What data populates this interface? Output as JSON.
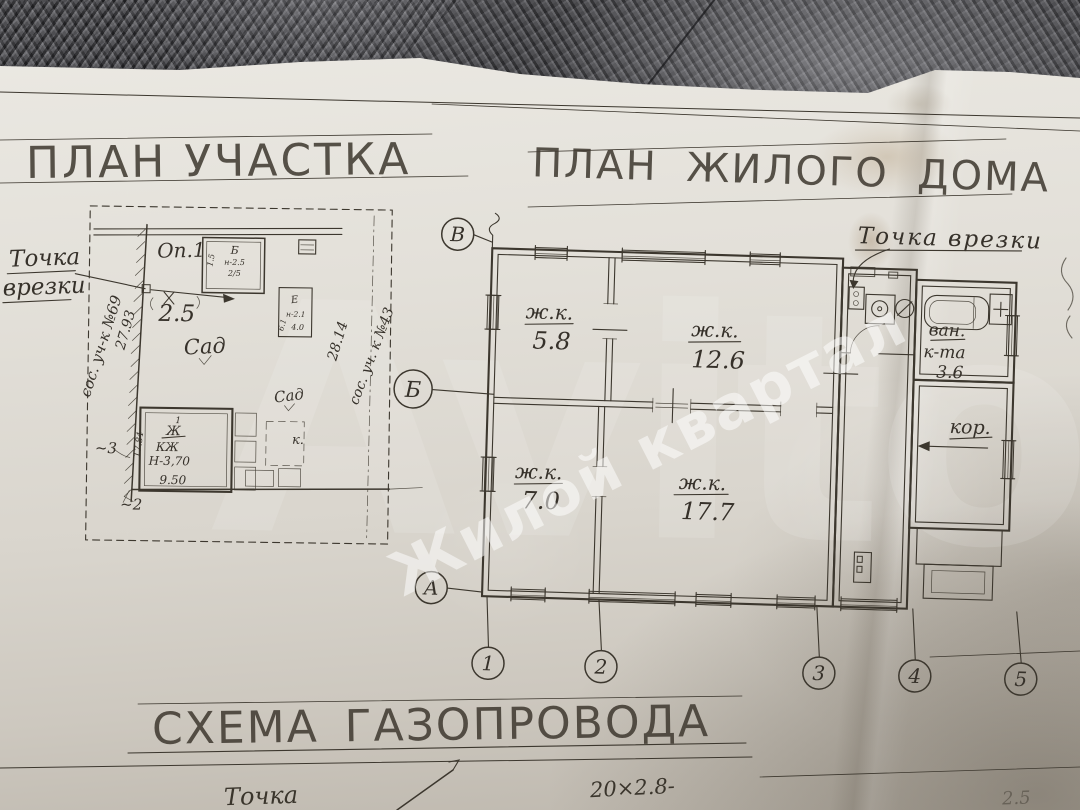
{
  "titles": {
    "site": "ПЛАН УЧАСТКА",
    "house": "ПЛАН ЖИЛОГО ДОМА",
    "gas": "СХЕМА ГАЗОПРОВОДА"
  },
  "watermark": {
    "brand": "Avito",
    "tagline": "Жилой квартал"
  },
  "site_plan": {
    "tie_word1": "Точка",
    "tie_word2": "врезки",
    "op": "Оп.1",
    "offset": "2.5",
    "garden1": "Сад",
    "garden2": "Сад",
    "k": "к.",
    "dim_left": "27.93",
    "neighbor_left": "сос. уч-к №69",
    "dim_right": "28.14",
    "neighbor_right": "сос. уч. к №43",
    "mark3": "~3",
    "mark2": "~2",
    "shed_b": {
      "letter": "Б",
      "h": "н-2.5",
      "n": "2/5",
      "s": "1.5"
    },
    "shed_e": {
      "letter": "Е",
      "h": "н-2.1",
      "a": "4.0",
      "b": "6.1"
    },
    "house": {
      "num": "1",
      "letter": "Ж",
      "type": "КЖ",
      "height": "Н-3,70",
      "width": "9.50",
      "side": "17.84"
    }
  },
  "floor_plan": {
    "tie": "Точка врезки",
    "rooms": [
      {
        "abbr": "ж.к.",
        "area": "5.8"
      },
      {
        "abbr": "ж.к.",
        "area": "12.6"
      },
      {
        "abbr": "ж.к.",
        "area": "7.0"
      },
      {
        "abbr": "ж.к.",
        "area": "17.7"
      }
    ],
    "bath_1": "ван.",
    "bath_2": "к-та",
    "bath_area": "3.6",
    "corridor": "кор.",
    "axis_rows": [
      "В",
      "Б",
      "А"
    ],
    "axis_cols": [
      "1",
      "2",
      "3",
      "4",
      "5"
    ]
  },
  "bottom": {
    "point": "Точка",
    "pipe": "20×2.8-",
    "faint": "2.5"
  }
}
